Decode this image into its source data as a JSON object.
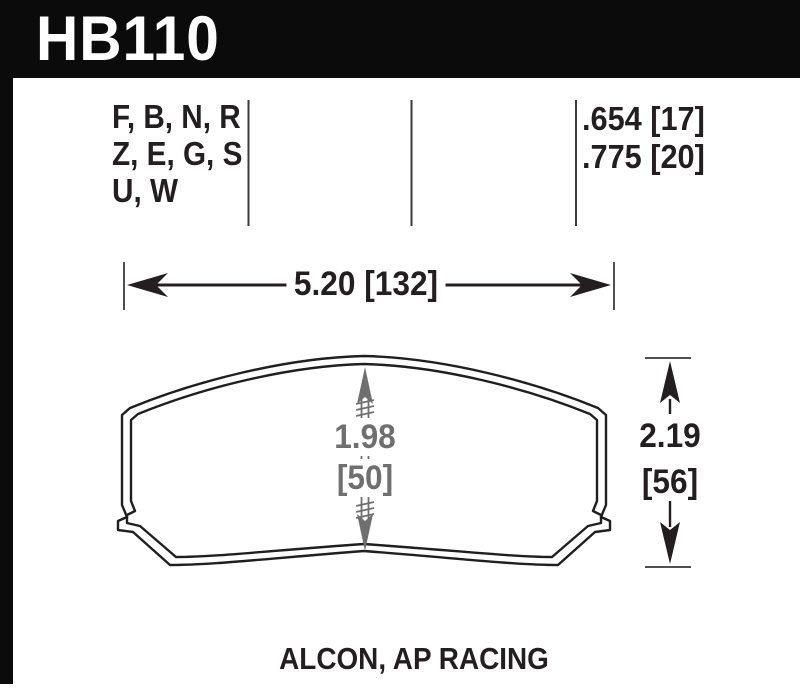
{
  "title_block": {
    "part_number": "HB110"
  },
  "compound_table": {
    "compound_codes_lines": [
      "F, B, N, R",
      "Z, E, G, S",
      "U, W"
    ],
    "pad_thicknesses": [
      ".654 [17]",
      ".775 [20]"
    ]
  },
  "dimensions": {
    "overall_width": "5.20 [132]",
    "friction_height_in": "1.98",
    "friction_height_mm": "[50]",
    "overall_height_in": "2.19",
    "overall_height_mm": "[56]"
  },
  "footer": {
    "applications": "ALCON, AP RACING"
  },
  "colors": {
    "header_bg": "#0b0b0b",
    "ink": "#231f20",
    "dimension_gray": "#6f6f6f",
    "tick_gray": "#4f4f4f"
  }
}
